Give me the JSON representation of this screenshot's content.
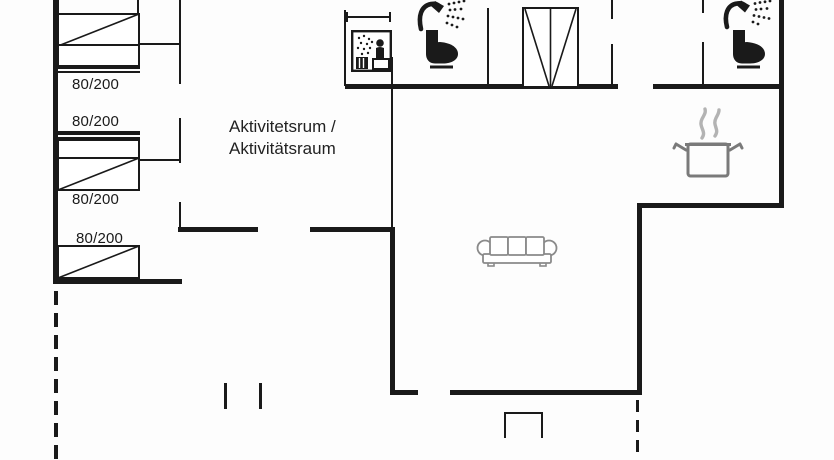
{
  "plan": {
    "title": "holiday-home-floor-plan",
    "activity_room": {
      "line1": "Aktivitetsrum /",
      "line2": "Aktivitätsraum"
    },
    "bed_size_labels": [
      "80/200",
      "80/200",
      "80/200",
      "80/200"
    ],
    "double_bed_size_label": "140/200",
    "icons": {
      "sauna": "sauna-icon",
      "shower_left": "shower-icon",
      "toilet_left": "toilet-icon",
      "shower_right": "shower-icon",
      "toilet_right": "toilet-icon",
      "cooking_pot": "cooking-pot-icon",
      "sofa": "sofa-icon"
    },
    "colors": {
      "wall": "#1a1a1a",
      "fixture_gray": "#7a7a7a",
      "sofa_gray": "#8a8a8a",
      "steam_gray": "#b3b3b3",
      "background": "#fdfdfd"
    }
  }
}
